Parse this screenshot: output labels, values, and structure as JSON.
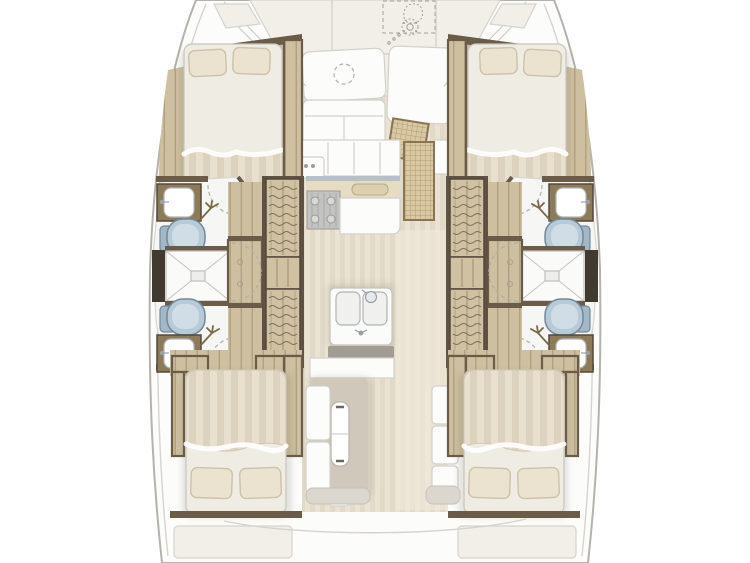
{
  "meta": {
    "subject": "Top-down interior layout plan of a four-cabin catamaran, bow at top",
    "view": "deck-plan",
    "orientation": "bow-up"
  },
  "colors": {
    "background": "#ffffff",
    "hull_outline": "#b5b2ab",
    "seam": "#d6d3cc",
    "panel": "#f2efe8",
    "saloon_floor": "#eae3d3",
    "saloon_floor_stripe": "#e2dac8",
    "cabin_sole": "#cdbf9f",
    "cabin_sole_line": "#b0a180",
    "dark_wood": "#6a5c48",
    "darker_wood": "#413a30",
    "bed_base": "#efece4",
    "duvet": "#dcd2bd",
    "duvet_stripe": "#e8e0ce",
    "pillow": "#ebe3d0",
    "bath_floor": "#f6f6f4",
    "toilet_fill": "#b6cad7",
    "toilet_stroke": "#74889a",
    "stair_wood": "#cfc1a1",
    "stair_line": "#7d6f57",
    "rattan": "#d8c8a3",
    "rattan_line": "#a68e64",
    "stove": "#c3c3c1",
    "counter_edge": "#b7c0c6",
    "counter_band": "#e6dcc4",
    "dark_counter": "#a29d94",
    "rug": "#cfc8bb",
    "white_fixture": "#fcfcfb",
    "shadow_c": "rgba(90,84,72,0.16)"
  },
  "inventory": {
    "double_beds": 4,
    "pillows": 8,
    "toilets": 4,
    "bathroom_sinks": 4,
    "shower_stalls": 2,
    "stair_flights": 4,
    "door_swings": 8,
    "galley_stove": 1,
    "galley_double_sink": 1,
    "dining_table": 1,
    "windlass": 1,
    "rattan_mats": 2
  },
  "areas": {
    "bow": "foredeck-with-windlass-locker",
    "port_hull": [
      "forward-double-cabin",
      "forward-head",
      "shared-shower",
      "aft-head",
      "aft-double-cabin"
    ],
    "starboard_hull": [
      "forward-double-cabin",
      "forward-head",
      "shared-shower",
      "aft-head",
      "aft-double-cabin"
    ],
    "center": [
      "forward-cockpit-lounge",
      "galley",
      "saloon-dining",
      "aft-deck"
    ]
  }
}
